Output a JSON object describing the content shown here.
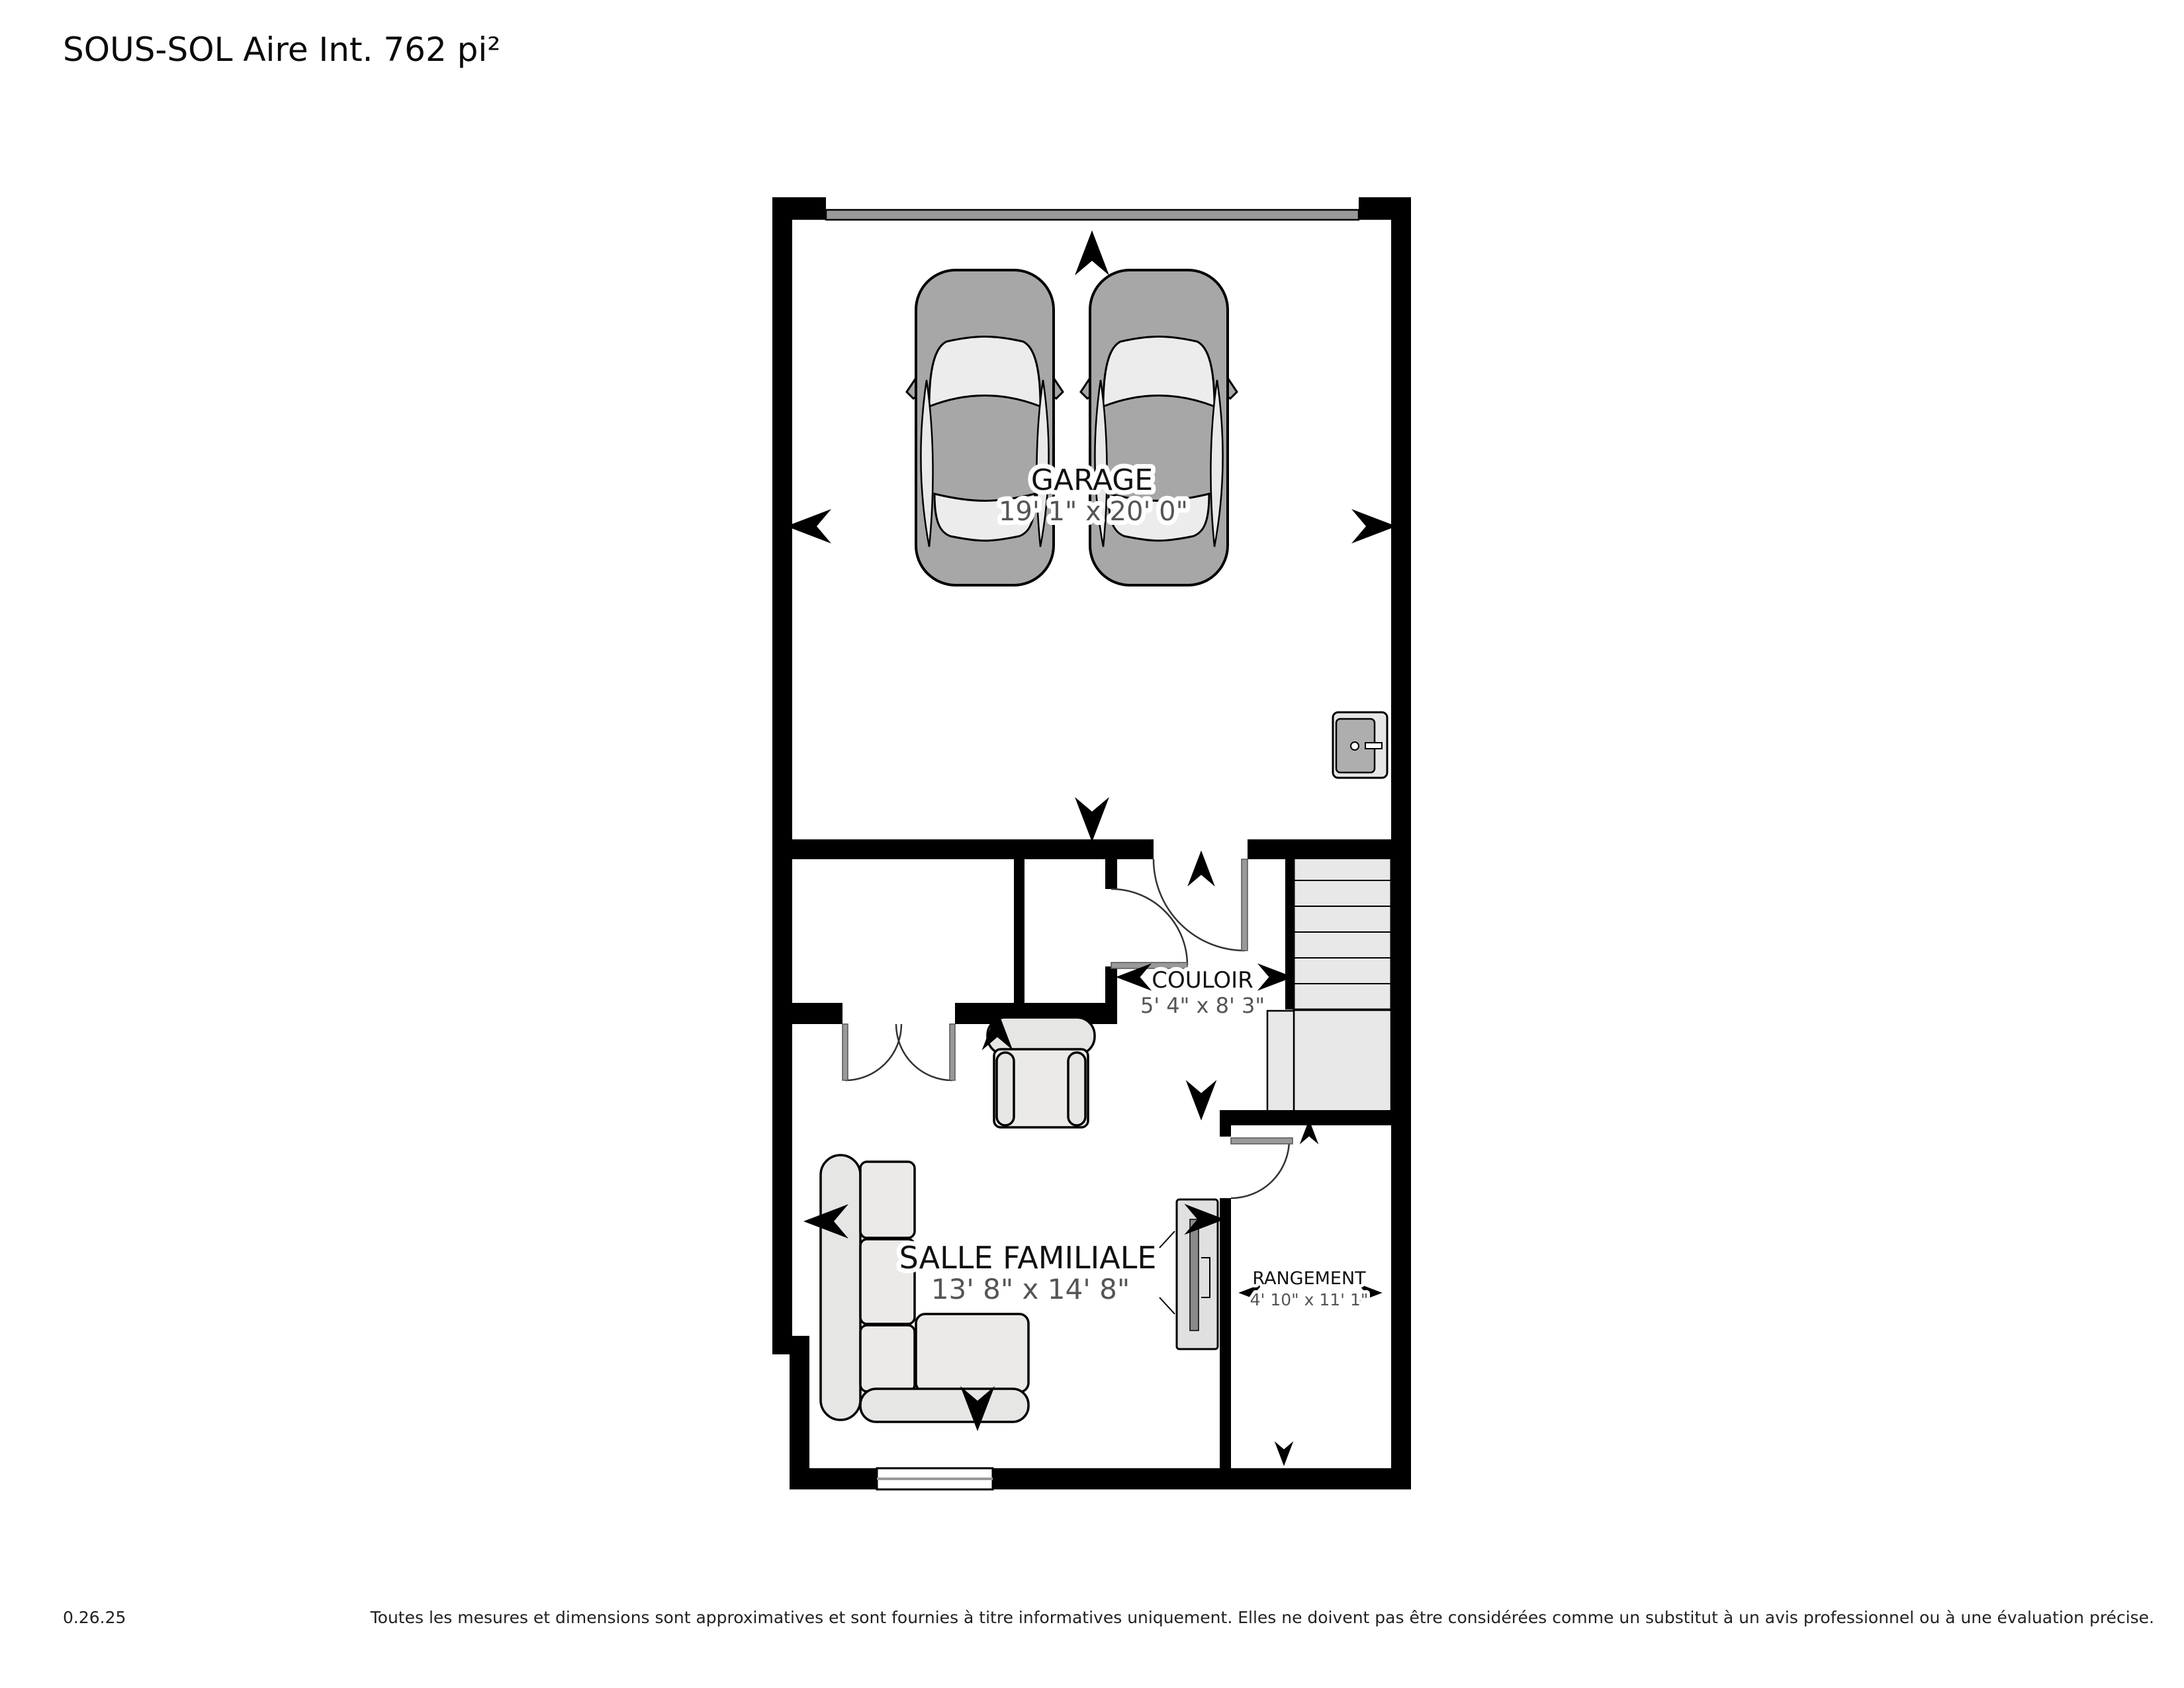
{
  "title": "SOUS-SOL Aire Int. 762 pi²",
  "rooms": {
    "garage": {
      "label": "GARAGE",
      "dims": "19' 1\" x 20' 0\""
    },
    "couloir": {
      "label": "COULOIR",
      "dims": "5' 4\" x 8' 3\""
    },
    "salle_familiale": {
      "label": "SALLE FAMILIALE",
      "dims": "13' 8\" x 14' 8\""
    },
    "rangement": {
      "label": "RANGEMENT",
      "dims": "4' 10\" x 11' 1\""
    }
  },
  "footer": {
    "version": "0.26.25",
    "disclaimer": "Toutes les mesures et dimensions sont approximatives et sont fournies à titre informatives uniquement. Elles ne doivent pas être considérées comme un substitut à un avis professionnel ou à une évaluation précise."
  },
  "colors": {
    "wall": "#000000",
    "garage_door": "#999999",
    "stairs_fill": "#e8e8e8",
    "furniture_fill": "#e6e6e4",
    "car_body": "#a7a7a7",
    "car_glass": "#ececec",
    "dims_text": "#555555",
    "title_text": "#0a0a0a"
  }
}
